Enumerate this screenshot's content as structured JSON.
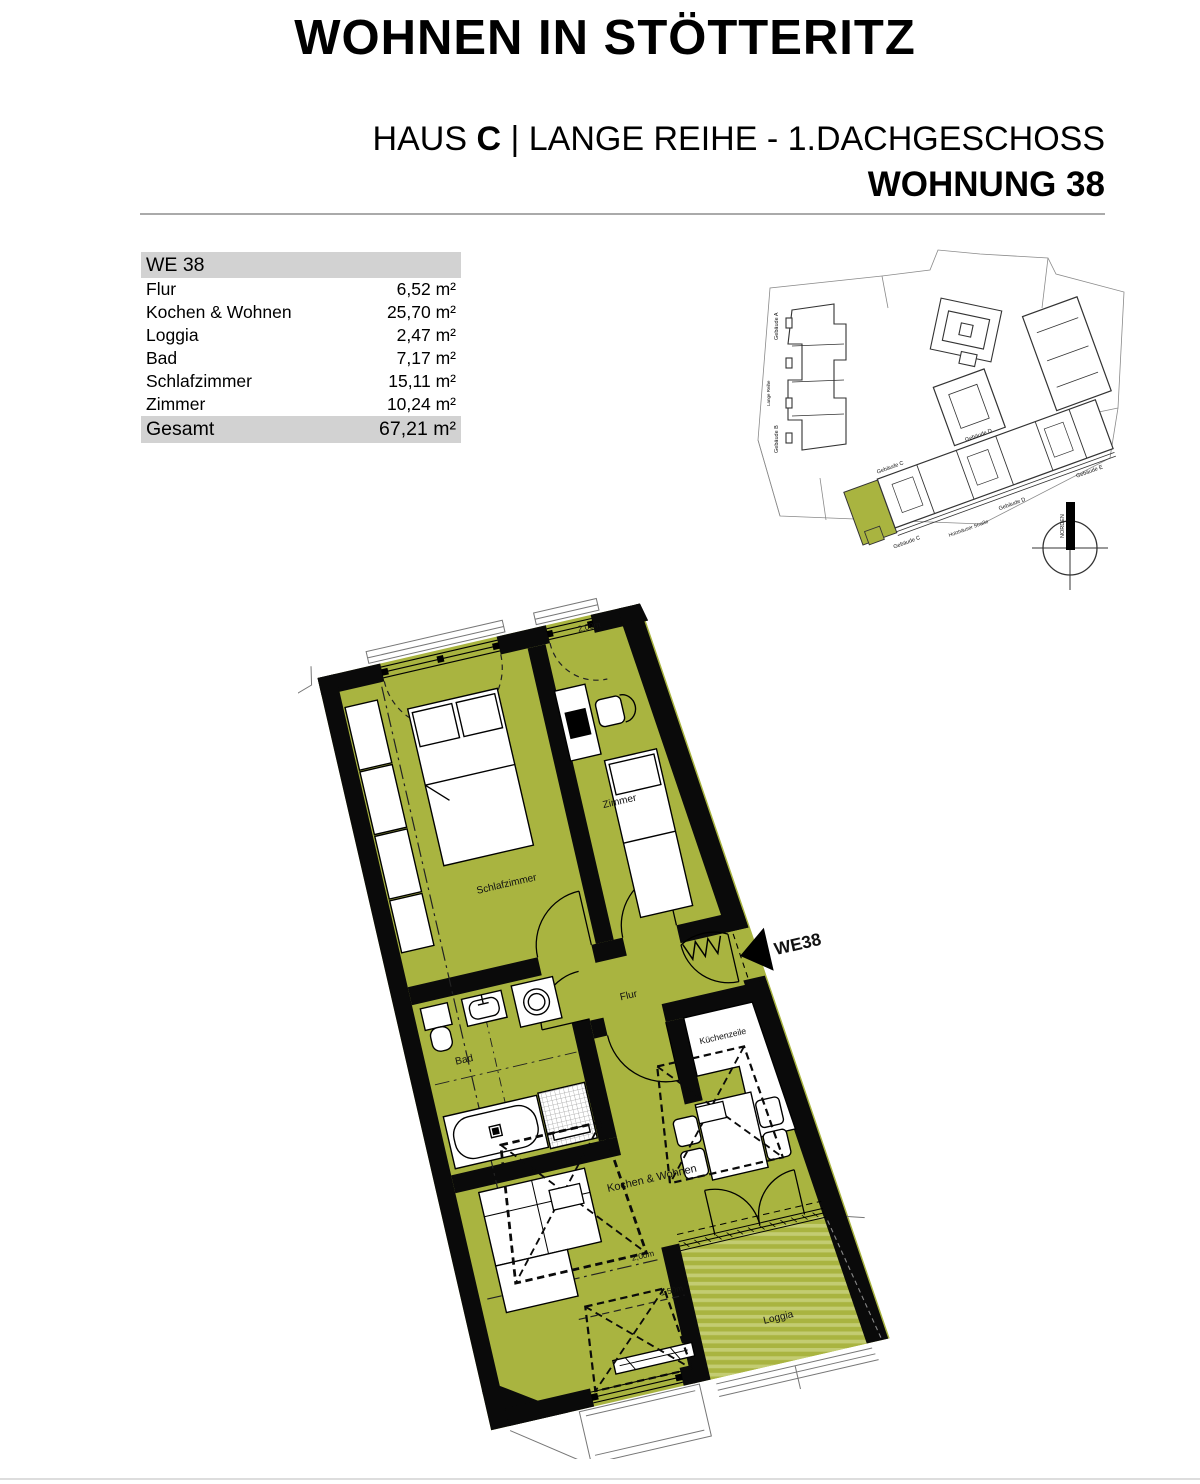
{
  "header": {
    "title": "WOHNEN IN STÖTTERITZ",
    "subtitle": {
      "prefix": "HAUS ",
      "bold": "C",
      "rest": " | LANGE REIHE - 1.DACHGESCHOSS"
    },
    "subtitle_line2": "WOHNUNG 38"
  },
  "area_table": {
    "header": "WE 38",
    "rows": [
      {
        "label": "Flur",
        "value": "6,52 m²"
      },
      {
        "label": "Kochen & Wohnen",
        "value": "25,70 m²"
      },
      {
        "label": "Loggia",
        "value": "2,47 m²"
      },
      {
        "label": "Bad",
        "value": "7,17 m²"
      },
      {
        "label": "Schlafzimmer",
        "value": "15,11 m²"
      },
      {
        "label": "Zimmer",
        "value": "10,24 m²"
      }
    ],
    "total": {
      "label": "Gesamt",
      "value": "67,21 m²"
    }
  },
  "site_plan": {
    "building_labels": [
      "Gebäude C",
      "Gebäude D",
      "Gebäude C",
      "Gebäude D",
      "Gebäude E",
      "Gebäude A",
      "Gebäude B",
      "Lange Reihe"
    ],
    "street_label": "Holzhäuser Straße",
    "compass_label": "NORDEN",
    "highlight_color": "#a9b440"
  },
  "floor_plan": {
    "unit_label": "WE38",
    "rooms": {
      "schlafzimmer": "Schlafzimmer",
      "zimmer": "Zimmer",
      "flur": "Flur",
      "bad": "Bad",
      "kueche": "Küchenzeile",
      "wohnen": "Kochen & Wohnen",
      "loggia": "Loggia"
    },
    "height_lines": {
      "left": "2,00m",
      "zimmer": "2,00m",
      "wohnen": "2,00m",
      "dormer": "1,50m"
    },
    "colors": {
      "floor": "#a9b440",
      "floor_stripe": "#c3cc72",
      "wall": "#0a0a0a"
    }
  }
}
